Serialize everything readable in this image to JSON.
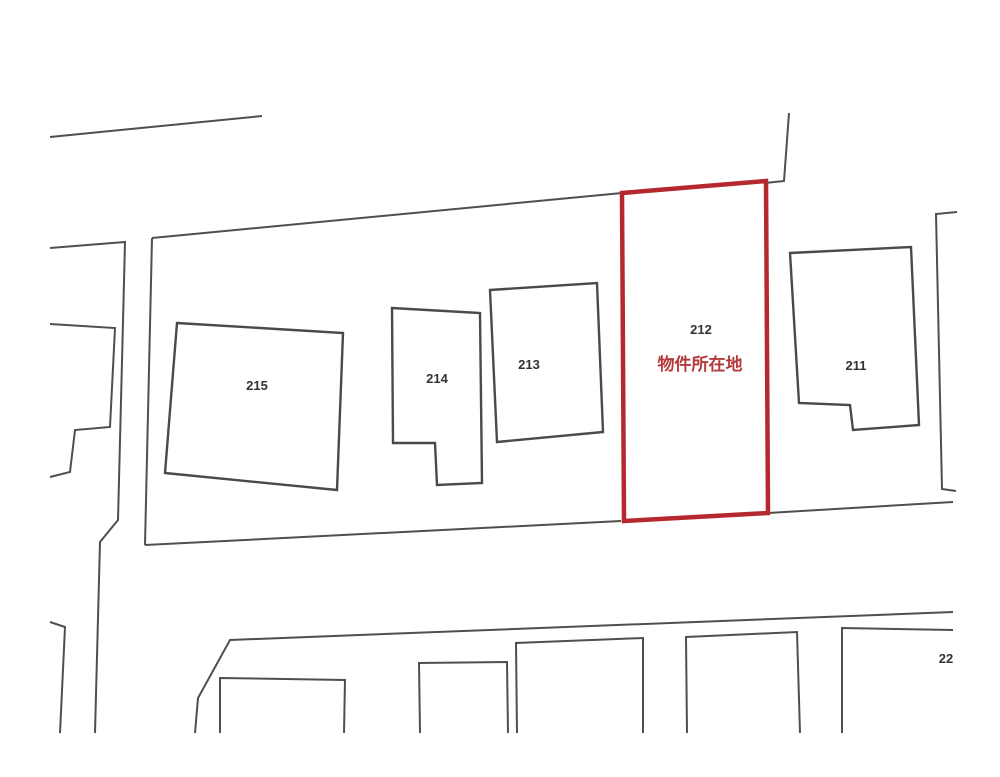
{
  "map": {
    "type": "cadastral-parcel-map",
    "background": "#ffffff",
    "colors": {
      "line": "#4f4f4f",
      "parcel_line": "#4a4a4a",
      "label_text": "#333333",
      "highlight_stroke": "#b5292e",
      "highlight_text": "#b43a3c"
    },
    "line_widths": {
      "boundary": 2,
      "parcel": 2.4,
      "highlight": 4.5
    },
    "label_font_size": 13,
    "caption_font_size": 17,
    "highlight": {
      "parcel_id": "212",
      "caption": "物件所在地"
    },
    "parcels": [
      {
        "id": "215",
        "label": "215",
        "points": "177,323 343,333 337,490 165,473",
        "label_x": 257,
        "label_y": 390,
        "highlighted": false
      },
      {
        "id": "214",
        "label": "214",
        "points": "392,308 480,313 482,483 437,485 435,443 393,443",
        "label_x": 437,
        "label_y": 383,
        "highlighted": false
      },
      {
        "id": "213",
        "label": "213",
        "points": "490,290 597,283 603,432 497,442",
        "label_x": 529,
        "label_y": 369,
        "highlighted": false
      },
      {
        "id": "212",
        "label": "212",
        "points": "622,193 766,181 768,513 624,521",
        "label_x": 701,
        "label_y": 334,
        "highlighted": true,
        "caption": "物件所在地",
        "caption_x": 700,
        "caption_y": 370
      },
      {
        "id": "211",
        "label": "211",
        "points": "790,253 911,247 919,425 853,430 850,405 799,403",
        "label_x": 856,
        "label_y": 370,
        "highlighted": false
      }
    ],
    "edge_label": {
      "text": "22",
      "x": 946,
      "y": 663
    },
    "boundary_lines": [
      {
        "name": "top-left-road-line",
        "points": "50,137 262,116"
      },
      {
        "name": "block-top-boundary",
        "points": "152,238 622,193"
      },
      {
        "name": "northeast-corner-line",
        "points": "765,183 784,181 789,113"
      },
      {
        "name": "east-map-edge",
        "points": "957,212 936,214 942,489 956,491"
      },
      {
        "name": "block-bottom-boundary-west",
        "points": "145,545 621,521"
      },
      {
        "name": "block-bottom-boundary-east",
        "points": "768,513 953,502"
      },
      {
        "name": "block-west-edge",
        "points": "152,238 145,545"
      },
      {
        "name": "west-road-edge",
        "points": "50,248 125,242 118,520 100,542 95,733"
      },
      {
        "name": "west-parcel-staircase",
        "points": "50,324 115,328 110,427 75,430 70,472 50,477"
      },
      {
        "name": "west-lower-parcel-edge",
        "points": "50,622 65,627 60,733"
      },
      {
        "name": "south-block-outer-edge",
        "points": "195,733 198,698 230,640 953,612"
      },
      {
        "name": "south-parcel-a",
        "points": "220,733 220,678 345,680 344,733"
      },
      {
        "name": "south-parcel-b",
        "points": "420,733 419,663 507,662 508,733"
      },
      {
        "name": "south-parcel-c",
        "points": "517,733 516,643 643,638 643,733"
      },
      {
        "name": "south-parcel-d",
        "points": "687,733 686,637 797,632 800,733"
      },
      {
        "name": "south-parcel-e",
        "points": "842,733 842,628 953,630"
      }
    ]
  }
}
